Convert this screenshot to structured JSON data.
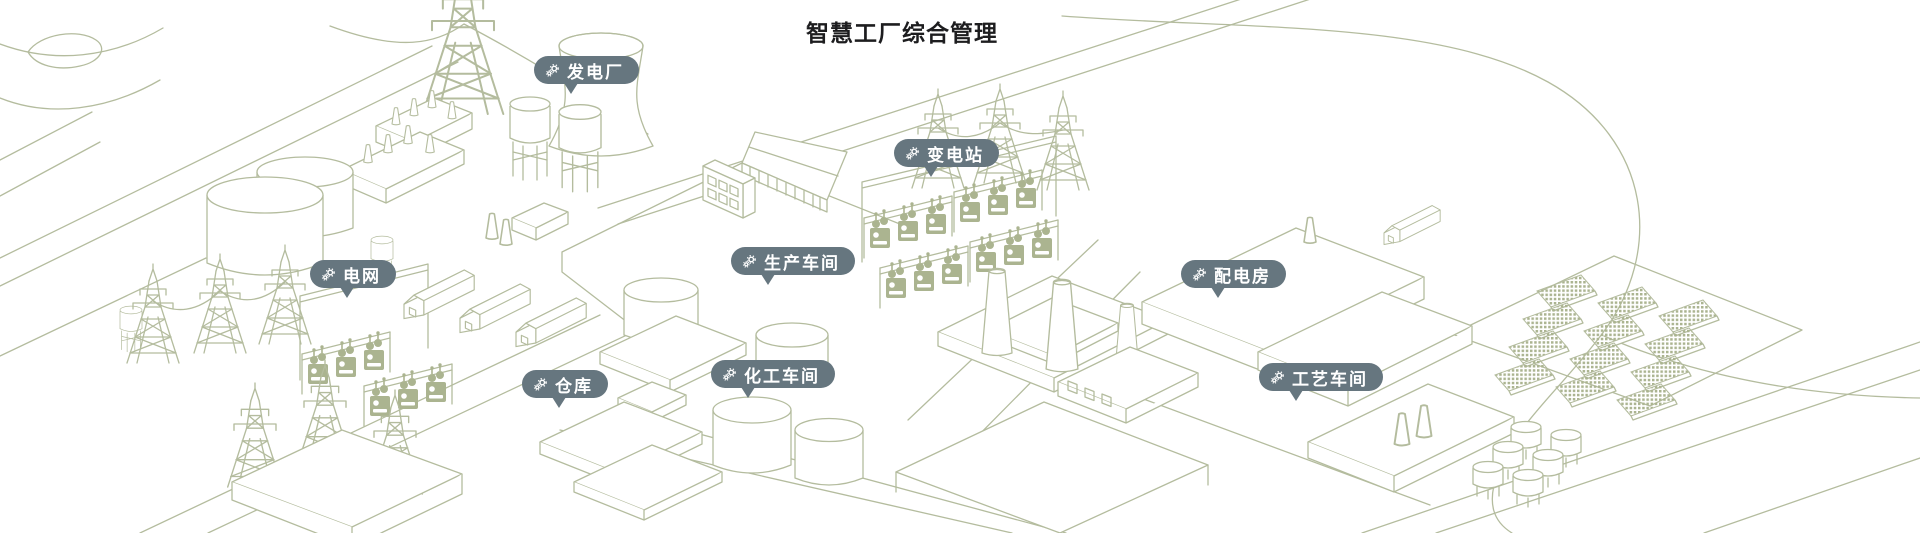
{
  "title": "智慧工厂综合管理",
  "colors": {
    "badge": "#66767f",
    "badge_text": "#ffffff",
    "line": "#b4bc9e",
    "fill": "#abb490",
    "title_text": "#1d1d1f",
    "background": "#ffffff"
  },
  "pins": [
    {
      "id": "power-plant",
      "label": "发电厂",
      "icon": "gears-icon"
    },
    {
      "id": "substation",
      "label": "变电站",
      "icon": "gears-icon"
    },
    {
      "id": "power-grid",
      "label": "电网",
      "icon": "gears-icon"
    },
    {
      "id": "production-workshop",
      "label": "生产车间",
      "icon": "gears-icon"
    },
    {
      "id": "distribution-room",
      "label": "配电房",
      "icon": "gears-icon"
    },
    {
      "id": "warehouse",
      "label": "仓库",
      "icon": "gears-icon"
    },
    {
      "id": "chemical-workshop",
      "label": "化工车间",
      "icon": "gears-icon"
    },
    {
      "id": "process-workshop",
      "label": "工艺车间",
      "icon": "gears-icon"
    }
  ]
}
